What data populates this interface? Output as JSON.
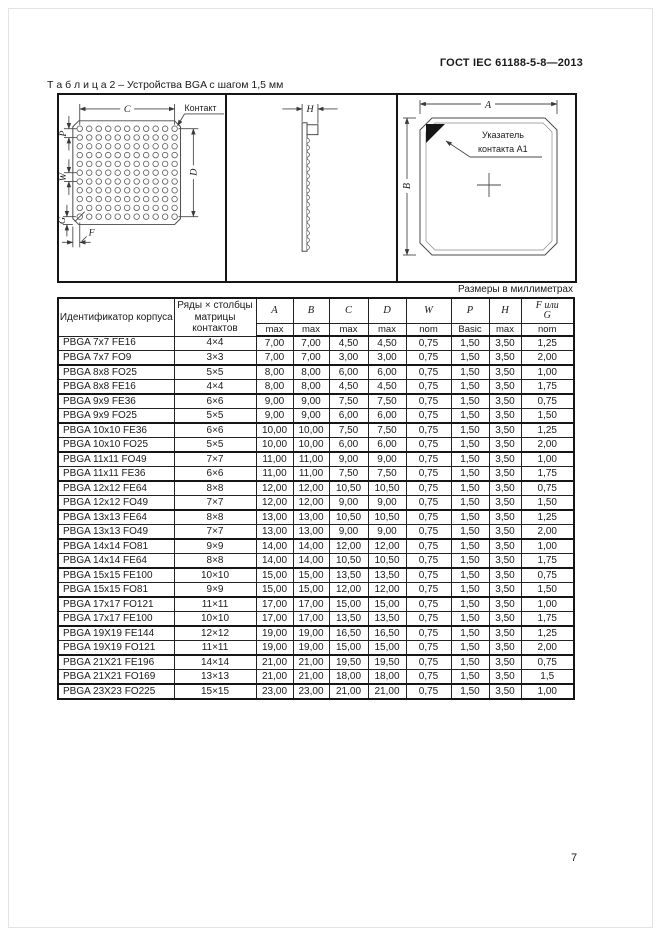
{
  "page": {
    "doc_ref": "ГОСТ IEC 61188-5-8—2013",
    "caption": "Т а б л и ц а  2 – Устройства BGA с шагом 1,5 мм",
    "units_note": "Размеры в миллиметрах",
    "page_number": "7"
  },
  "figure": {
    "bottom_view": {
      "contact_label": "Контакт",
      "dim_c": "C",
      "dim_d": "D",
      "dim_p": "P",
      "dim_w": "W",
      "dim_g": "G",
      "dim_f": "F"
    },
    "side_view": {
      "dim_h": "H"
    },
    "top_view": {
      "dim_a": "A",
      "dim_b": "B",
      "indicator_line1": "Указатель",
      "indicator_line2": "контакта A1"
    }
  },
  "table": {
    "headers": {
      "id": "Идентификатор корпуса",
      "matrix_1": "Ряды × столбцы",
      "matrix_2": "матрицы",
      "matrix_3": "контактов",
      "dims": [
        "A",
        "B",
        "C",
        "D",
        "W",
        "P",
        "H"
      ],
      "fg_top": "F или",
      "fg_bottom": "G",
      "subs": [
        "max",
        "max",
        "max",
        "max",
        "nom",
        "Basic",
        "max",
        "nom"
      ]
    },
    "rows": [
      [
        "PBGA 7x7 FE16",
        "4×4",
        "7,00",
        "7,00",
        "4,50",
        "4,50",
        "0,75",
        "1,50",
        "3,50",
        "1,25"
      ],
      [
        "PBGA 7x7 FO9",
        "3×3",
        "7,00",
        "7,00",
        "3,00",
        "3,00",
        "0,75",
        "1,50",
        "3,50",
        "2,00"
      ],
      [
        "PBGA 8x8 FO25",
        "5×5",
        "8,00",
        "8,00",
        "6,00",
        "6,00",
        "0,75",
        "1,50",
        "3,50",
        "1,00"
      ],
      [
        "PBGA 8x8 FE16",
        "4×4",
        "8,00",
        "8,00",
        "4,50",
        "4,50",
        "0,75",
        "1,50",
        "3,50",
        "1,75"
      ],
      [
        "PBGA 9x9 FE36",
        "6×6",
        "9,00",
        "9,00",
        "7,50",
        "7,50",
        "0,75",
        "1,50",
        "3,50",
        "0,75"
      ],
      [
        "PBGA 9x9 FO25",
        "5×5",
        "9,00",
        "9,00",
        "6,00",
        "6,00",
        "0,75",
        "1,50",
        "3,50",
        "1,50"
      ],
      [
        "PBGA 10x10 FE36",
        "6×6",
        "10,00",
        "10,00",
        "7,50",
        "7,50",
        "0,75",
        "1,50",
        "3,50",
        "1,25"
      ],
      [
        "PBGA 10x10 FO25",
        "5×5",
        "10,00",
        "10,00",
        "6,00",
        "6,00",
        "0,75",
        "1,50",
        "3,50",
        "2,00"
      ],
      [
        "PBGA 11x11 FO49",
        "7×7",
        "11,00",
        "11,00",
        "9,00",
        "9,00",
        "0,75",
        "1,50",
        "3,50",
        "1,00"
      ],
      [
        "PBGA 11x11 FE36",
        "6×6",
        "11,00",
        "11,00",
        "7,50",
        "7,50",
        "0,75",
        "1,50",
        "3,50",
        "1,75"
      ],
      [
        "PBGA 12x12 FE64",
        "8×8",
        "12,00",
        "12,00",
        "10,50",
        "10,50",
        "0,75",
        "1,50",
        "3,50",
        "0,75"
      ],
      [
        "PBGA 12x12 FO49",
        "7×7",
        "12,00",
        "12,00",
        "9,00",
        "9,00",
        "0,75",
        "1,50",
        "3,50",
        "1,50"
      ],
      [
        "PBGA 13x13 FE64",
        "8×8",
        "13,00",
        "13,00",
        "10,50",
        "10,50",
        "0,75",
        "1,50",
        "3,50",
        "1,25"
      ],
      [
        "PBGA 13x13 FO49",
        "7×7",
        "13,00",
        "13,00",
        "9,00",
        "9,00",
        "0,75",
        "1,50",
        "3,50",
        "2,00"
      ],
      [
        "PBGA 14x14 FO81",
        "9×9",
        "14,00",
        "14,00",
        "12,00",
        "12,00",
        "0,75",
        "1,50",
        "3,50",
        "1,00"
      ],
      [
        "PBGA 14x14 FE64",
        "8×8",
        "14,00",
        "14,00",
        "10,50",
        "10,50",
        "0,75",
        "1,50",
        "3,50",
        "1,75"
      ],
      [
        "PBGA 15x15 FE100",
        "10×10",
        "15,00",
        "15,00",
        "13,50",
        "13,50",
        "0,75",
        "1,50",
        "3,50",
        "0,75"
      ],
      [
        "PBGA 15x15 FO81",
        "9×9",
        "15,00",
        "15,00",
        "12,00",
        "12,00",
        "0,75",
        "1,50",
        "3,50",
        "1,50"
      ],
      [
        "PBGA 17x17 FO121",
        "11×11",
        "17,00",
        "17,00",
        "15,00",
        "15,00",
        "0,75",
        "1,50",
        "3,50",
        "1,00"
      ],
      [
        "PBGA 17x17 FE100",
        "10×10",
        "17,00",
        "17,00",
        "13,50",
        "13,50",
        "0,75",
        "1,50",
        "3,50",
        "1,75"
      ],
      [
        "PBGA 19X19 FE144",
        "12×12",
        "19,00",
        "19,00",
        "16,50",
        "16,50",
        "0,75",
        "1,50",
        "3,50",
        "1,25"
      ],
      [
        "PBGA 19X19 FO121",
        "11×11",
        "19,00",
        "19,00",
        "15,00",
        "15,00",
        "0,75",
        "1,50",
        "3,50",
        "2,00"
      ],
      [
        "PBGA 21X21 FE196",
        "14×14",
        "21,00",
        "21,00",
        "19,50",
        "19,50",
        "0,75",
        "1,50",
        "3,50",
        "0,75"
      ],
      [
        "PBGA 21X21 FO169",
        "13×13",
        "21,00",
        "21,00",
        "18,00",
        "18,00",
        "0,75",
        "1,50",
        "3,50",
        "1,5"
      ],
      [
        "PBGA 23X23 FO225",
        "15×15",
        "23,00",
        "23,00",
        "21,00",
        "21,00",
        "0,75",
        "1,50",
        "3,50",
        "1,00"
      ]
    ]
  }
}
